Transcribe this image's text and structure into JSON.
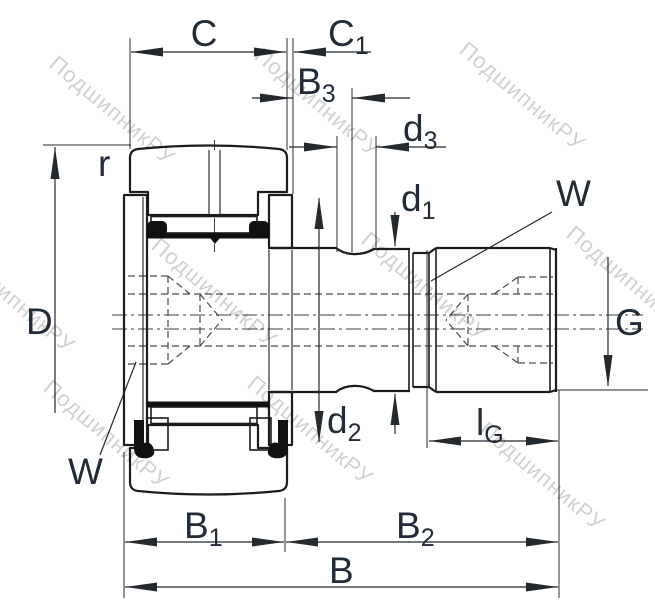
{
  "drawing": {
    "title": "cam-follower-stud-bearing-cross-section",
    "labels": {
      "C": "C",
      "C1": {
        "base": "C",
        "sub": "1"
      },
      "B3": {
        "base": "B",
        "sub": "3"
      },
      "d3": {
        "base": "d",
        "sub": "3"
      },
      "d1": {
        "base": "d",
        "sub": "1"
      },
      "W_top": "W",
      "r": "r",
      "D": "D",
      "d2": {
        "base": "d",
        "sub": "2"
      },
      "G": "G",
      "lG": {
        "base": "l",
        "sub": "G"
      },
      "B1": {
        "base": "B",
        "sub": "1"
      },
      "B2": {
        "base": "B",
        "sub": "2"
      },
      "B": "B",
      "W_bottom": "W"
    },
    "watermark": {
      "text": "ПодшипникРУ"
    },
    "colors": {
      "line": "#1c1c1c",
      "label": "#222b38",
      "watermark": "#c6c6c6",
      "background": "#ffffff"
    }
  }
}
